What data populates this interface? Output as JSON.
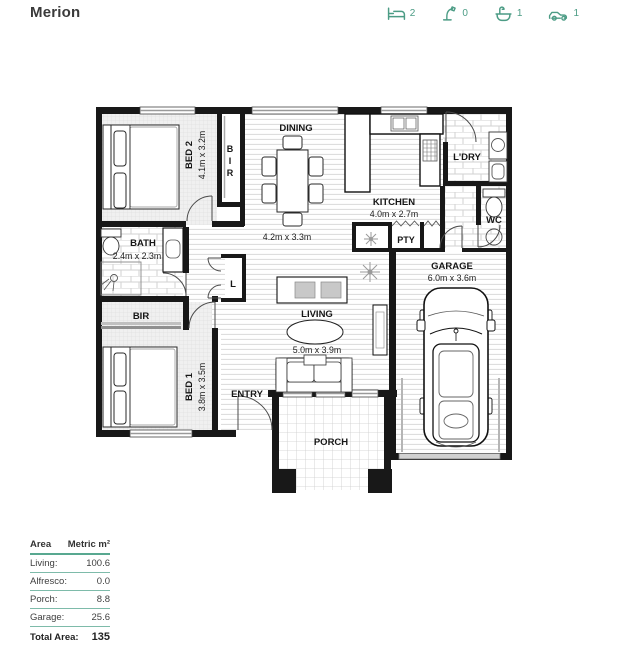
{
  "header": {
    "title": "Merion",
    "stats": [
      {
        "icon": "bed-icon",
        "count": "2"
      },
      {
        "icon": "shower-icon",
        "count": "0"
      },
      {
        "icon": "bath-icon",
        "count": "1"
      },
      {
        "icon": "car-icon",
        "count": "1"
      }
    ]
  },
  "plan": {
    "rooms": {
      "bed2": {
        "name": "BED 2",
        "dims": "4.1m x 3.2m"
      },
      "bir2": {
        "letters": [
          "B",
          "I",
          "R"
        ]
      },
      "dining": {
        "name": "DINING",
        "dims": "4.2m x 3.3m"
      },
      "kitchen": {
        "name": "KITCHEN",
        "dims": "4.0m x 2.7m"
      },
      "ldry": {
        "name": "L'DRY"
      },
      "wc": {
        "name": "WC"
      },
      "pty": {
        "name": "PTY"
      },
      "bath": {
        "name": "BATH",
        "dims": "2.4m x 2.3m"
      },
      "linen": {
        "name": "L"
      },
      "bir1": {
        "name": "BIR"
      },
      "bed1": {
        "name": "BED 1",
        "dims": "3.8m x 3.5m"
      },
      "living": {
        "name": "LIVING",
        "dims": "5.0m x 3.9m"
      },
      "entry": {
        "name": "ENTRY"
      },
      "garage": {
        "name": "GARAGE",
        "dims": "6.0m x 3.6m"
      },
      "porch": {
        "name": "PORCH"
      }
    }
  },
  "area_table": {
    "headers": [
      "Area",
      "Metric m²"
    ],
    "rows": [
      {
        "label": "Living:",
        "value": "100.6"
      },
      {
        "label": "Alfresco:",
        "value": "0.0"
      },
      {
        "label": "Porch:",
        "value": "8.8"
      },
      {
        "label": "Garage:",
        "value": "25.6"
      }
    ],
    "total": {
      "label": "Total Area:",
      "value": "135"
    }
  },
  "colors": {
    "accent": "#4c9c85",
    "table_line": "#7ebbaa",
    "wall": "#181818"
  }
}
